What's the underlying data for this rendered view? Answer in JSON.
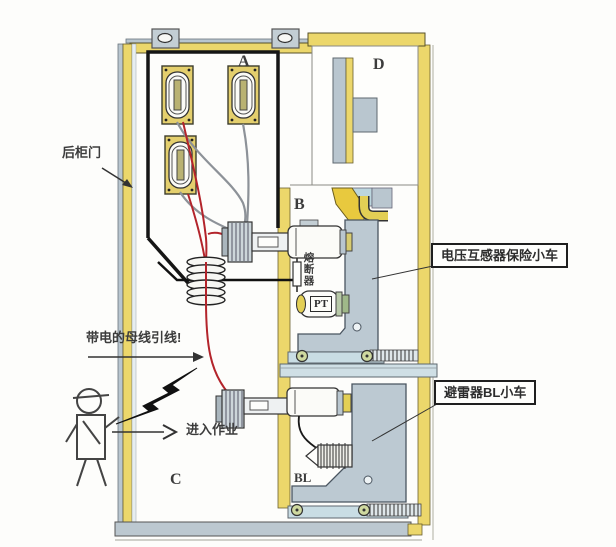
{
  "meta": {
    "width": 616,
    "height": 547,
    "description": "switchgear cabinet rear-door safety diagram"
  },
  "compartments": {
    "a": "A",
    "b": "B",
    "c": "C",
    "d": "D"
  },
  "labels": {
    "rear_door": "后柜门",
    "live_busbar_warning": "带电的母线引线!",
    "enter_work": "进入作业",
    "fuse": "熔断器",
    "pt": "PT",
    "bl": "BL"
  },
  "callouts": {
    "pt_trolley": "电压互感器保险小车",
    "arrester_trolley": "避雷器BL小车"
  },
  "colors": {
    "frame_yellow": "#ecd76b",
    "metal_gray": "#b9c6cf",
    "rail_blue": "#c9dde4",
    "wire_red": "#b3242b",
    "wire_gray": "#8d9298",
    "outline": "#222222",
    "background": "#fdfdfb"
  }
}
